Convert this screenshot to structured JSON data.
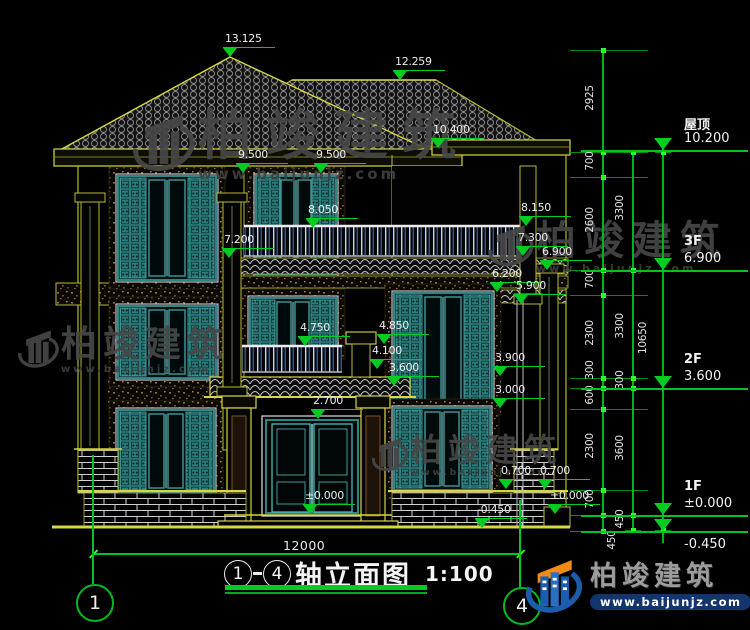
{
  "watermark": {
    "brand": "柏竣建筑",
    "url": "www.baijunjz.com"
  },
  "logo": {
    "brand": "柏竣建筑",
    "url": "www.baijunjz.com"
  },
  "title": {
    "axis_start": "1",
    "axis_end": "4",
    "text": "轴立面图",
    "scale": "1:100"
  },
  "ground": {
    "overall_width": "12000",
    "axis_start": "1",
    "axis_end": "4"
  },
  "levels": [
    {
      "name": "屋顶",
      "value": "10.200",
      "y": 150
    },
    {
      "name": "3F",
      "value": "6.900",
      "y": 270
    },
    {
      "name": "2F",
      "value": "3.600",
      "y": 388
    },
    {
      "name": "1F",
      "value": "±0.000",
      "y": 515
    },
    {
      "name": "",
      "value": "-0.450",
      "y": 531,
      "below": true
    }
  ],
  "elevation_markers": [
    {
      "value": "13.125",
      "x": 230,
      "y": 57
    },
    {
      "value": "12.259",
      "x": 400,
      "y": 80
    },
    {
      "value": "10.400",
      "x": 438,
      "y": 148
    },
    {
      "value": "9.500",
      "x": 243,
      "y": 173
    },
    {
      "value": "9.500",
      "x": 321,
      "y": 173
    },
    {
      "value": "8.050",
      "x": 313,
      "y": 228
    },
    {
      "value": "8.150",
      "x": 526,
      "y": 226
    },
    {
      "value": "7.300",
      "x": 523,
      "y": 256
    },
    {
      "value": "7.200",
      "x": 229,
      "y": 258
    },
    {
      "value": "6.900",
      "x": 547,
      "y": 270
    },
    {
      "value": "6.200",
      "x": 497,
      "y": 292
    },
    {
      "value": "5.900",
      "x": 521,
      "y": 304
    },
    {
      "value": "4.850",
      "x": 384,
      "y": 344
    },
    {
      "value": "4.750",
      "x": 305,
      "y": 346
    },
    {
      "value": "4.100",
      "x": 377,
      "y": 369
    },
    {
      "value": "3.900",
      "x": 500,
      "y": 376
    },
    {
      "value": "3.600",
      "x": 394,
      "y": 386
    },
    {
      "value": "3.000",
      "x": 500,
      "y": 408
    },
    {
      "value": "2.700",
      "x": 318,
      "y": 419
    },
    {
      "value": "0.700",
      "x": 506,
      "y": 489
    },
    {
      "value": "0.700",
      "x": 545,
      "y": 489
    },
    {
      "value": "±0.000",
      "x": 310,
      "y": 514
    },
    {
      "value": "±0.000",
      "x": 555,
      "y": 514
    },
    {
      "value": "-0.450",
      "x": 482,
      "y": 528
    }
  ],
  "dim_chains": [
    {
      "x": 603,
      "labels": [
        {
          "t": "2925",
          "y": 101
        },
        {
          "t": "700",
          "y": 164
        },
        {
          "t": "2600",
          "y": 223
        },
        {
          "t": "700",
          "y": 282
        },
        {
          "t": "2300",
          "y": 336
        },
        {
          "t": "300",
          "y": 373
        },
        {
          "t": "600",
          "y": 398
        },
        {
          "t": "2300",
          "y": 449
        },
        {
          "t": "700",
          "y": 502
        },
        {
          "t": "450",
          "y": 543,
          "dx": 22
        }
      ]
    },
    {
      "x": 633,
      "labels": [
        {
          "t": "3300",
          "y": 211
        },
        {
          "t": "3300",
          "y": 329
        },
        {
          "t": "300",
          "y": 383
        },
        {
          "t": "3600",
          "y": 451
        },
        {
          "t": "450",
          "y": 522
        }
      ]
    },
    {
      "x": 663,
      "labels": [
        {
          "t": "10650",
          "y": 341,
          "dx": -7
        }
      ]
    }
  ]
}
